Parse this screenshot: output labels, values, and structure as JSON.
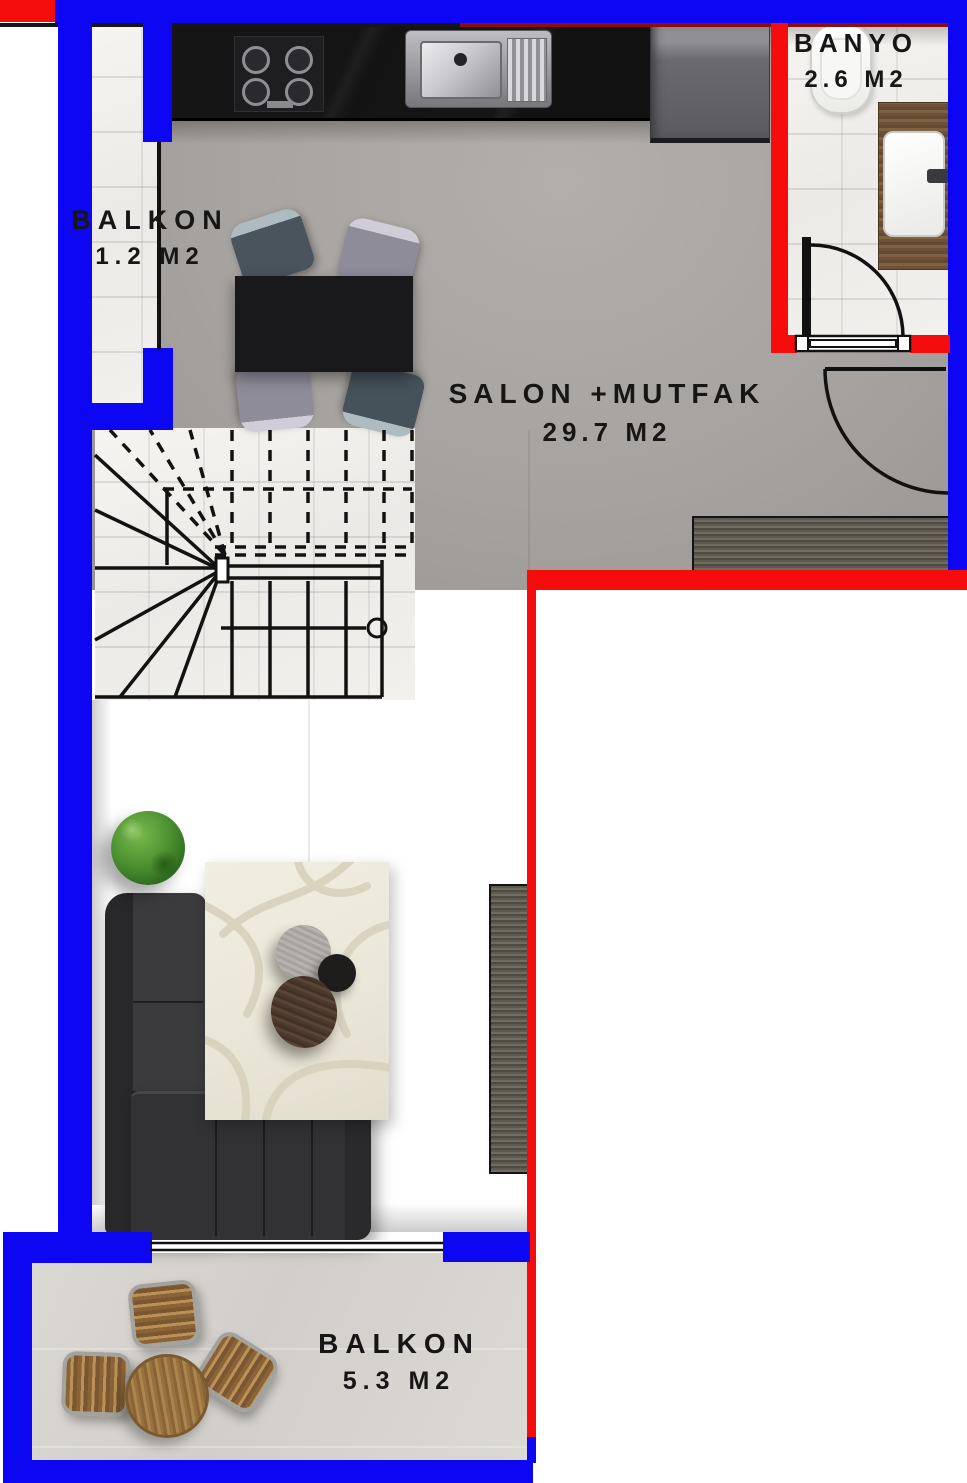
{
  "rooms": {
    "balcony_top": {
      "label": "BALKON",
      "area": "1.2 M2"
    },
    "bathroom": {
      "label": "BANYO",
      "area": "2.6 M2"
    },
    "living_kitchen": {
      "label": "SALON +MUTFAK",
      "area": "29.7 M2"
    },
    "balcony_bottom": {
      "label": "BALKON",
      "area": "5.3 M2"
    }
  },
  "colors": {
    "exterior_wall": "#0d06f3",
    "interior_wall": "#f50d0d",
    "floor_main": "#a6a29f",
    "floor_balcony": "#d7d4d0",
    "floor_wet": "#f2f0ed",
    "linework": "#121212"
  },
  "furniture_icons": [
    "kitchen-counter-icon",
    "gas-stove-icon",
    "kitchen-sink-icon",
    "refrigerator-icon",
    "dining-table-icon",
    "dining-chair-icon",
    "staircase-icon",
    "toilet-icon",
    "vanity-sink-icon",
    "bathroom-door-icon",
    "entrance-door-icon",
    "sideboard-icon",
    "tv-unit-icon",
    "sectional-sofa-icon",
    "area-rug-icon",
    "coffee-table-icon",
    "potted-plant-icon",
    "balcony-table-icon",
    "balcony-chair-icon",
    "sliding-window-icon"
  ]
}
